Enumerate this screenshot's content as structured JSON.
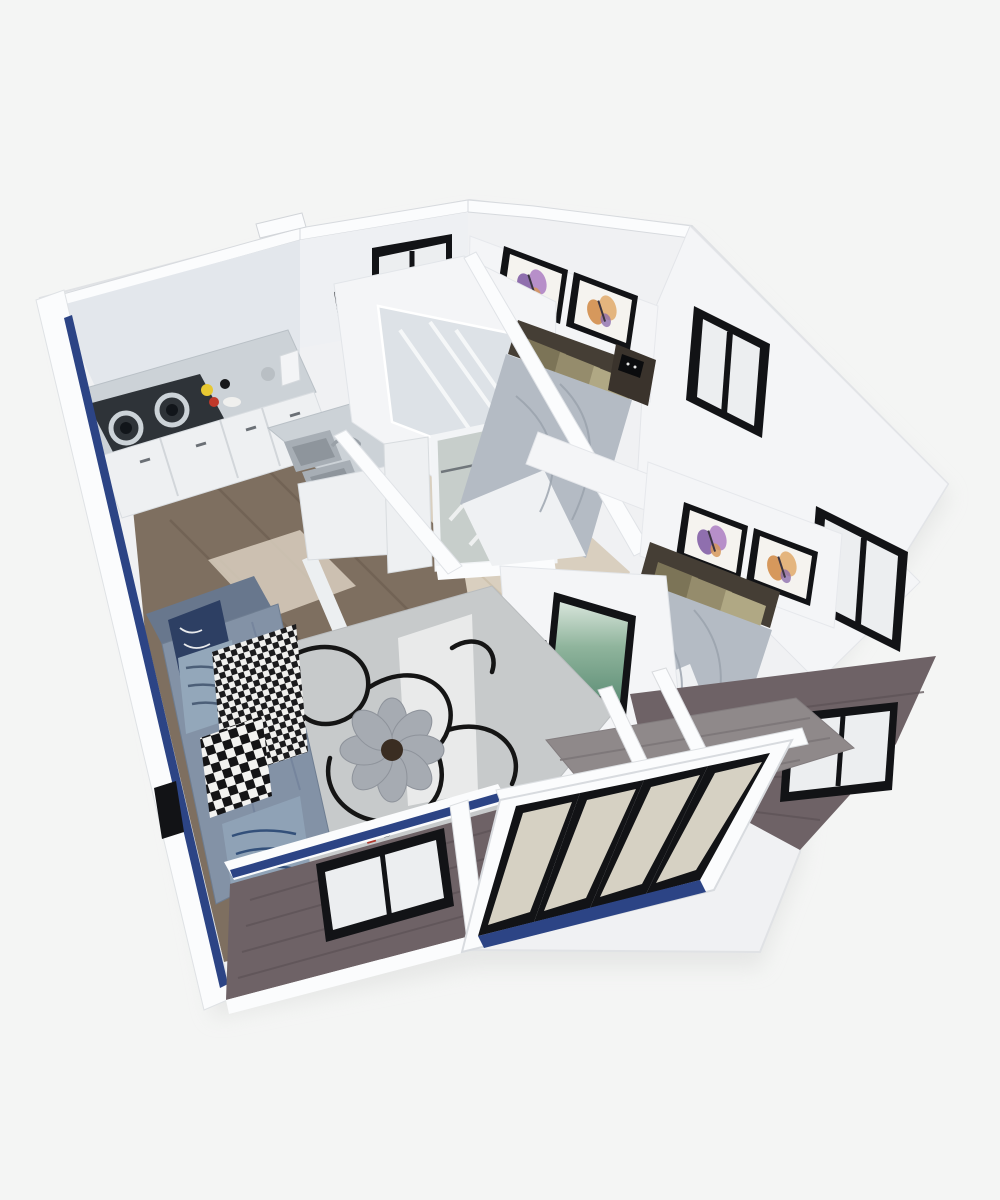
{
  "scene": {
    "type": "3d-isometric-floorplan-render",
    "subject": "expandable container home cutaway, top-down isometric view, no visible text",
    "rooms": [
      {
        "name": "kitchen",
        "objects": [
          "two-burner-gas-cooktop",
          "marble-countertop",
          "white-base-cabinets",
          "drawer-stack",
          "double-sink",
          "faucet",
          "mugs-and-dishes",
          "canister"
        ]
      },
      {
        "name": "bathroom",
        "objects": [
          "walk-in-shower-enclosure",
          "black-wall-panel",
          "small-black-framed-window"
        ]
      },
      {
        "name": "hallway",
        "objects": [
          "glass-entry-door",
          "white-interior-door",
          "light-wood-floor"
        ]
      },
      {
        "name": "living-room",
        "objects": [
          "l-shaped-gray-blue-sofa",
          "navy-pillow",
          "striped-pillow",
          "houndstooth-throw",
          "checkered-pillow",
          "striped-bolster",
          "gray-rug-with-black-rope-swirl",
          "flower-shaped-pouf",
          "tv-on-partition-wall",
          "black-media-bar",
          "floor-clutter"
        ]
      },
      {
        "name": "bedroom-1",
        "objects": [
          "double-bed",
          "khaki-pillows",
          "gray-bedding",
          "white-sheet-fold",
          "dark-headboard",
          "dark-nightstand-with-alarm-clock",
          "two-butterfly-art-prints",
          "black-framed-window"
        ]
      },
      {
        "name": "bedroom-2",
        "objects": [
          "double-bed",
          "khaki-pillows",
          "gray-bedding",
          "white-sheet-fold",
          "dark-headboard",
          "two-butterfly-art-prints",
          "black-framed-window"
        ]
      },
      {
        "name": "exterior",
        "objects": [
          "dark-woodgrain-siding",
          "white-corner-trims",
          "navy-accent-stripes",
          "folded-out-sliding-glass-door-wall",
          "gray-plank-deck",
          "front-wall-window",
          "side-wall-window",
          "white-vent-box"
        ]
      }
    ]
  },
  "palette": {
    "bg": "#f4f5f4",
    "shadow": "#dddedd",
    "house_base": "#f0f1f3",
    "roof_white": "#fbfcfd",
    "wall_white": "#f4f5f7",
    "wall_light": "#eef0f3",
    "wall_interior": "#e3e7ec",
    "blue_stripe": "#2c4485",
    "frame_black": "#121316",
    "glass_white": "#eceef0",
    "glass_beige": "#d6d1c3",
    "door_glass": "#c7cecb",
    "shower_glass": "#dde2e7",
    "wood_dark": "#7e6f60",
    "wood_light": "#d9cfbf",
    "deck_gray": "#8f898a",
    "exterior_wood": "#6e6266",
    "marble": "#ccd2d7",
    "cabinet_white": "#eef0f2",
    "stove_black": "#2e3338",
    "burner_gray": "#ccd3d8",
    "sink_gray": "#a7aeb5",
    "rug_gray": "#c7cacb",
    "rug_white": "#e9eaea",
    "rug_line": "#151515",
    "sofa_base": "#8392a6",
    "sofa_back": "#68778d",
    "pillow_navy": "#2d3f63",
    "pillow_stripe": "#93a7ba",
    "bolster": "#8fa2b6",
    "pouf_gray": "#a6abb2",
    "pouf_center": "#3a2d22",
    "bedding": "#b4bbc4",
    "sheet_white": "#eff1f3",
    "khaki": "#958c6c",
    "khaki_light": "#b0a884",
    "khaki_dark": "#7c7457",
    "headboard": "#453e35",
    "nightstand": "#3a332c",
    "art_canvas": "#f5f3ef",
    "art_purple": "#8f6fae",
    "art_orange": "#d6985c"
  }
}
